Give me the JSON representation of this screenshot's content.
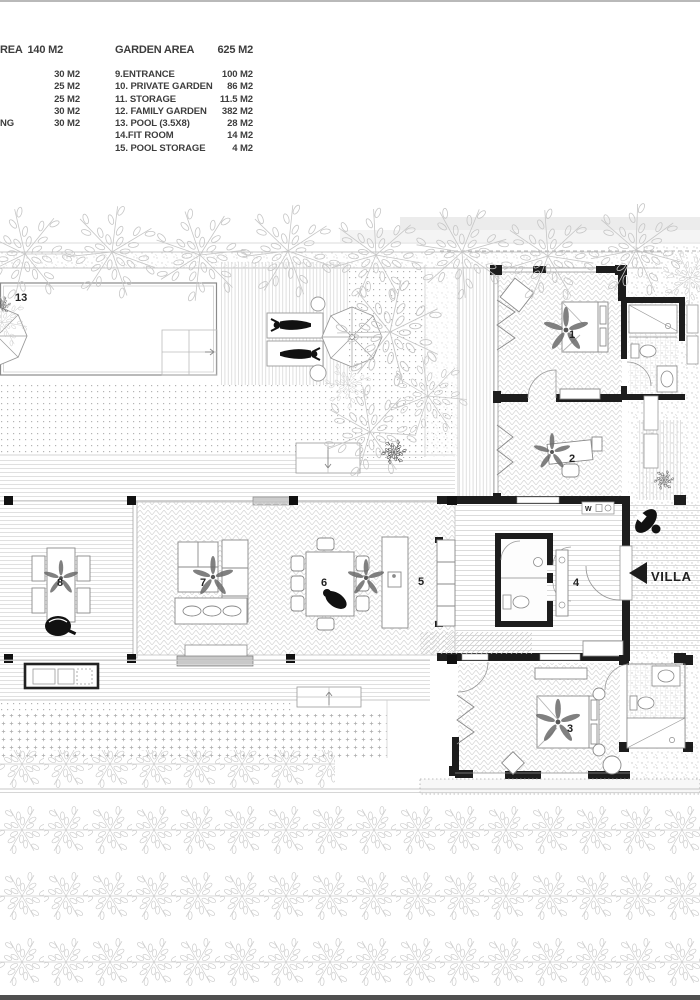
{
  "legend": {
    "left_table": {
      "header_fragment": "REA",
      "header_value": "140 M2",
      "rows": [
        {
          "label_fragment": "",
          "value": "30 M2"
        },
        {
          "label_fragment": "",
          "value": "25 M2"
        },
        {
          "label_fragment": "",
          "value": "25 M2"
        },
        {
          "label_fragment": "",
          "value": "30 M2"
        },
        {
          "label_fragment": "NG",
          "value": "30 M2"
        }
      ]
    },
    "garden_table": {
      "header": "GARDEN AREA",
      "header_value": "625 M2",
      "rows": [
        {
          "label": "9.ENTRANCE",
          "value": "100 M2"
        },
        {
          "label": "10. PRIVATE GARDEN",
          "value": "86 M2"
        },
        {
          "label": "11. STORAGE",
          "value": "11.5 M2"
        },
        {
          "label": "12. FAMILY GARDEN",
          "value": "382 M2"
        },
        {
          "label": "13. POOL (3.5X8)",
          "value": "28 M2"
        },
        {
          "label": "14.FIT ROOM",
          "value": "14 M2"
        },
        {
          "label": "15. POOL STORAGE",
          "value": "4 M2"
        }
      ]
    }
  },
  "plan": {
    "room_labels": {
      "pool": "13",
      "bedroom1": "1",
      "office2": "2",
      "bedroom3": "3",
      "entry4": "4",
      "kitchen5": "5",
      "dining6": "6",
      "living7": "7",
      "terrace8": "8"
    },
    "villa_label": "VILLA",
    "utility_label": "W",
    "colors": {
      "wall": "#1d1d1d",
      "accent": "#111111",
      "hatch": "#d8d8d8",
      "tree": "#c6c6c6",
      "text": "#3d3d3d"
    }
  }
}
